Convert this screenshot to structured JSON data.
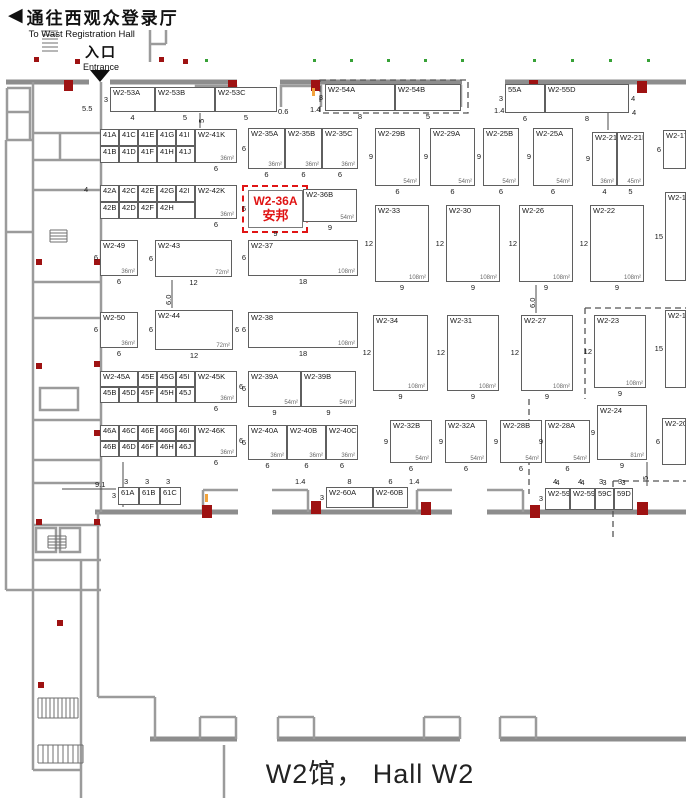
{
  "header": {
    "west_hall_cn": "通往西观众登录厅",
    "west_hall_en": "To Wast Registration Hall",
    "entrance_cn": "入口",
    "entrance_en": "Entrance"
  },
  "footer": {
    "label": "W2馆， Hall W2"
  },
  "colors": {
    "highlight_red": "#e01414",
    "wall_gray": "#8d8d8d",
    "marker_red": "#9e1212"
  },
  "highlight_booth": {
    "id": "W2-36A",
    "company": "安邦"
  },
  "passages": [
    {
      "id": "to-hall-w3-left",
      "cn": "通往W3号馆",
      "en": "To Hall W3",
      "x": 258,
      "top": 34,
      "order": "cn-first"
    },
    {
      "id": "to-hall-w3-right",
      "cn": "通往W3号馆",
      "en": "To Hall W3",
      "x": 483,
      "top": 34,
      "order": "cn-first"
    },
    {
      "id": "to-hall-w1-left",
      "cn": "通往W1号馆",
      "en": "To Hall W1",
      "x": 261,
      "top": 474,
      "order": "en-first"
    },
    {
      "id": "to-hall-w1-right",
      "cn": "通往W1号馆",
      "en": "To Hall W1",
      "x": 470,
      "top": 472,
      "order": "en-first"
    },
    {
      "id": "to-hall-w2-left",
      "cn": "通往W2号馆",
      "en": "To Hall W2",
      "x": 258,
      "top": 692,
      "order": "cn-first"
    },
    {
      "id": "to-hall-w2-right",
      "cn": "通往W2号馆",
      "en": "To Hall W2",
      "x": 483,
      "top": 692,
      "order": "cn-first"
    }
  ],
  "rooms": [
    {
      "id": "wc-upper",
      "cn": "WC",
      "x": 59,
      "y": 163,
      "cs": 11
    },
    {
      "id": "meeting-room",
      "cn": "会议室",
      "en": "Meeting Room",
      "x": 59,
      "y": 201,
      "cs": 13
    },
    {
      "id": "restaurant",
      "cn": "餐饮",
      "en": "Restaurant",
      "x": 56,
      "y": 339,
      "cs": 13
    },
    {
      "id": "wc-lower",
      "cn": "WC",
      "x": 59,
      "y": 422,
      "cs": 11
    },
    {
      "id": "self-help-center",
      "cn": "自助中心",
      "en": "Self-help center",
      "x": 55,
      "y": 500,
      "cs": 10
    }
  ],
  "booths": [
    {
      "l": "W2-53A",
      "x": 110,
      "y": 87,
      "w": 45,
      "h": 25,
      "dl": "3",
      "db": "4"
    },
    {
      "l": "W2-53B",
      "x": 155,
      "y": 87,
      "w": 60,
      "h": 25,
      "db": "5"
    },
    {
      "l": "W2-53C",
      "x": 215,
      "y": 87,
      "w": 62,
      "h": 25,
      "db": "5"
    },
    {
      "l": "W2-54A",
      "x": 325,
      "y": 84,
      "w": 70,
      "h": 27,
      "dl": "3",
      "db": "8"
    },
    {
      "l": "W2-54B",
      "x": 395,
      "y": 84,
      "w": 66,
      "h": 27,
      "db": "5"
    },
    {
      "l": "55A",
      "x": 505,
      "y": 84,
      "w": 40,
      "h": 29,
      "dl": "3",
      "db": "6"
    },
    {
      "l": "W2-55D",
      "x": 545,
      "y": 84,
      "w": 84,
      "h": 29,
      "db": "8",
      "dr": "4"
    },
    {
      "l": "W2-35A",
      "x": 248,
      "y": 128,
      "w": 37,
      "h": 41,
      "a": "36m²",
      "dl": "6",
      "db": "6"
    },
    {
      "l": "W2-35B",
      "x": 285,
      "y": 128,
      "w": 37,
      "h": 41,
      "a": "36m²",
      "db": "6"
    },
    {
      "l": "W2-35C",
      "x": 322,
      "y": 128,
      "w": 36,
      "h": 41,
      "a": "36m²",
      "db": "6"
    },
    {
      "l": "W2-29B",
      "x": 375,
      "y": 128,
      "w": 45,
      "h": 58,
      "a": "54m²",
      "dl": "9",
      "db": "6"
    },
    {
      "l": "W2-29A",
      "x": 430,
      "y": 128,
      "w": 45,
      "h": 58,
      "a": "54m²",
      "dl": "9",
      "db": "6"
    },
    {
      "l": "W2-25B",
      "x": 483,
      "y": 128,
      "w": 36,
      "h": 58,
      "a": "54m²",
      "dl": "9",
      "db": "6"
    },
    {
      "l": "W2-25A",
      "x": 533,
      "y": 128,
      "w": 40,
      "h": 58,
      "a": "54m²",
      "dl": "9",
      "db": "6"
    },
    {
      "l": "W2-21A",
      "x": 592,
      "y": 132,
      "w": 25,
      "h": 54,
      "a": "36m²",
      "dl": "9",
      "db": "4"
    },
    {
      "l": "W2-21B",
      "x": 617,
      "y": 132,
      "w": 27,
      "h": 54,
      "a": "45m²",
      "db": "5"
    },
    {
      "l": "W2-17",
      "x": 663,
      "y": 130,
      "w": 23,
      "h": 39,
      "dl": "6"
    },
    {
      "l": "W2-36A",
      "x": 248,
      "y": 190,
      "w": 55,
      "h": 38,
      "hl": true,
      "sub": "安邦",
      "db": "9",
      "dl": "6"
    },
    {
      "l": "W2-36B",
      "x": 303,
      "y": 189,
      "w": 54,
      "h": 33,
      "a": "54m²",
      "db": "9"
    },
    {
      "l": "W2-33",
      "x": 375,
      "y": 205,
      "w": 54,
      "h": 77,
      "a": "108m²",
      "dl": "12",
      "db": "9"
    },
    {
      "l": "W2-30",
      "x": 446,
      "y": 205,
      "w": 54,
      "h": 77,
      "a": "108m²",
      "dl": "12",
      "db": "9"
    },
    {
      "l": "W2-26",
      "x": 519,
      "y": 205,
      "w": 54,
      "h": 77,
      "a": "108m²",
      "dl": "12",
      "db": "9"
    },
    {
      "l": "W2-22",
      "x": 590,
      "y": 205,
      "w": 54,
      "h": 77,
      "a": "108m²",
      "dl": "12",
      "db": "9"
    },
    {
      "l": "W2-18",
      "x": 665,
      "y": 192,
      "w": 21,
      "h": 89,
      "dl": "15"
    },
    {
      "l": "W2-49",
      "x": 100,
      "y": 240,
      "w": 38,
      "h": 36,
      "a": "36m²",
      "dl": "6",
      "db": "6"
    },
    {
      "l": "W2-43",
      "x": 155,
      "y": 240,
      "w": 77,
      "h": 37,
      "a": "72m²",
      "dl": "6",
      "db": "12"
    },
    {
      "l": "W2-37",
      "x": 248,
      "y": 240,
      "w": 110,
      "h": 36,
      "a": "108m²",
      "dl": "6",
      "db": "18"
    },
    {
      "l": "W2-50",
      "x": 100,
      "y": 312,
      "w": 38,
      "h": 36,
      "a": "36m²",
      "dl": "6",
      "db": "6"
    },
    {
      "l": "W2-44",
      "x": 155,
      "y": 310,
      "w": 78,
      "h": 40,
      "a": "72m²",
      "dl": "6",
      "dr": "6",
      "db": "12"
    },
    {
      "l": "W2-38",
      "x": 248,
      "y": 312,
      "w": 110,
      "h": 36,
      "a": "108m²",
      "dl": "6",
      "db": "18"
    },
    {
      "l": "W2-34",
      "x": 373,
      "y": 315,
      "w": 55,
      "h": 76,
      "a": "108m²",
      "dl": "12",
      "db": "9"
    },
    {
      "l": "W2-31",
      "x": 447,
      "y": 315,
      "w": 52,
      "h": 76,
      "a": "108m²",
      "dl": "12",
      "db": "9"
    },
    {
      "l": "W2-27",
      "x": 521,
      "y": 315,
      "w": 52,
      "h": 76,
      "a": "108m²",
      "dl": "12",
      "db": "9"
    },
    {
      "l": "W2-23",
      "x": 594,
      "y": 315,
      "w": 52,
      "h": 73,
      "a": "108m²",
      "dl": "12",
      "db": "9"
    },
    {
      "l": "W2-19",
      "x": 665,
      "y": 310,
      "w": 21,
      "h": 78,
      "dl": "15"
    },
    {
      "l": "W2-39A",
      "x": 248,
      "y": 371,
      "w": 53,
      "h": 36,
      "a": "54m²",
      "dl": "6",
      "db": "9"
    },
    {
      "l": "W2-39B",
      "x": 301,
      "y": 371,
      "w": 55,
      "h": 36,
      "a": "54m²",
      "db": "9"
    },
    {
      "l": "W2-40A",
      "x": 248,
      "y": 425,
      "w": 39,
      "h": 35,
      "a": "36m²",
      "dl": "6",
      "db": "6"
    },
    {
      "l": "W2-40B",
      "x": 287,
      "y": 425,
      "w": 39,
      "h": 35,
      "a": "36m²",
      "db": "6"
    },
    {
      "l": "W2-40C",
      "x": 326,
      "y": 425,
      "w": 32,
      "h": 35,
      "a": "36m²",
      "db": "6"
    },
    {
      "l": "W2-32B",
      "x": 390,
      "y": 420,
      "w": 42,
      "h": 43,
      "a": "54m²",
      "dl": "9",
      "db": "6"
    },
    {
      "l": "W2-32A",
      "x": 445,
      "y": 420,
      "w": 42,
      "h": 43,
      "a": "54m²",
      "dl": "9",
      "db": "6"
    },
    {
      "l": "W2-28B",
      "x": 500,
      "y": 420,
      "w": 42,
      "h": 43,
      "a": "54m²",
      "dl": "9",
      "db": "6"
    },
    {
      "l": "W2-28A",
      "x": 545,
      "y": 420,
      "w": 45,
      "h": 43,
      "a": "54m²",
      "dl": "9",
      "db": "6"
    },
    {
      "l": "W2-24",
      "x": 597,
      "y": 405,
      "w": 50,
      "h": 55,
      "a": "81m²",
      "dl": "9",
      "db": "9"
    },
    {
      "l": "W2-20",
      "x": 662,
      "y": 418,
      "w": 24,
      "h": 47,
      "dl": "6"
    },
    {
      "l": "W2-60A",
      "x": 326,
      "y": 487,
      "w": 47,
      "h": 21,
      "dl": "3",
      "dt": "8"
    },
    {
      "l": "W2-60B",
      "x": 373,
      "y": 487,
      "w": 35,
      "h": 21,
      "dt": "6"
    },
    {
      "l": "W2-59A",
      "x": 545,
      "y": 488,
      "w": 25,
      "h": 22,
      "dl": "3",
      "dt": "4"
    },
    {
      "l": "W2-59B",
      "x": 570,
      "y": 488,
      "w": 25,
      "h": 22,
      "dt": "4"
    },
    {
      "l": "59C",
      "x": 595,
      "y": 488,
      "w": 19,
      "h": 22,
      "dt": "3"
    },
    {
      "l": "59D",
      "x": 614,
      "y": 488,
      "w": 19,
      "h": 22,
      "dt": "3"
    }
  ],
  "grids": [
    {
      "x": 100,
      "y": 129,
      "cw": 19,
      "rh": 17,
      "rows": [
        [
          "41A",
          "41C",
          "41E",
          "41G",
          "41I"
        ],
        [
          "41B",
          "41D",
          "41F",
          "41H",
          "41J"
        ]
      ],
      "k": {
        "l": "W2-41K",
        "w": 42,
        "a": "36m²"
      },
      "db": "6"
    },
    {
      "x": 100,
      "y": 185,
      "cw": 19,
      "rh": 17,
      "rows": [
        [
          "42A",
          "42C",
          "42E",
          "42G",
          "42I"
        ],
        [
          "42B",
          "42D",
          "42F",
          "42H"
        ]
      ],
      "spans": [
        [
          1,
          1,
          1,
          1,
          1
        ],
        [
          1,
          1,
          1,
          2
        ]
      ],
      "k": {
        "l": "W2-42K",
        "w": 42,
        "a": "36m²"
      },
      "db": "6"
    },
    {
      "x": 100,
      "y": 371,
      "cw": 19,
      "rh": 16,
      "rows": [
        [
          "W2-45A",
          "45E",
          "45G",
          "45I"
        ],
        [
          "45B",
          "45D",
          "45F",
          "45H",
          "45J"
        ]
      ],
      "spans": [
        [
          2,
          1,
          1,
          1
        ],
        [
          1,
          1,
          1,
          1,
          1
        ]
      ],
      "k": {
        "l": "W2-45K",
        "w": 42,
        "a": "36m²"
      },
      "db": "6",
      "dr": "6"
    },
    {
      "x": 100,
      "y": 425,
      "cw": 19,
      "rh": 16,
      "rows": [
        [
          "46A",
          "46C",
          "46E",
          "46G",
          "46I"
        ],
        [
          "46B",
          "46D",
          "46F",
          "46H",
          "46J"
        ]
      ],
      "k": {
        "l": "W2-46K",
        "w": 42,
        "a": "36m²"
      },
      "db": "6",
      "dr": "6"
    },
    {
      "x": 118,
      "y": 487,
      "cw": 21,
      "rh": 18,
      "rows": [
        [
          "61A",
          "61B",
          "61C"
        ]
      ],
      "dl": "3"
    }
  ],
  "texts": [
    {
      "t": "5.5",
      "x": 82,
      "y": 104
    },
    {
      "t": "0.6",
      "x": 278,
      "y": 107
    },
    {
      "t": "1.4",
      "x": 310,
      "y": 105
    },
    {
      "t": "1.4",
      "x": 494,
      "y": 106
    },
    {
      "t": "4",
      "x": 632,
      "y": 108
    },
    {
      "t": "5",
      "x": 197,
      "y": 123,
      "rot": 1
    },
    {
      "t": "6.0",
      "x": 164,
      "y": 305,
      "rot": 1
    },
    {
      "t": "6.0",
      "x": 528,
      "y": 308,
      "rot": 1
    },
    {
      "t": "9.1",
      "x": 95,
      "y": 480
    },
    {
      "t": "3",
      "x": 124,
      "y": 477
    },
    {
      "t": "3",
      "x": 145,
      "y": 477
    },
    {
      "t": "3",
      "x": 166,
      "y": 477
    },
    {
      "t": "1.4",
      "x": 295,
      "y": 477
    },
    {
      "t": "1.4",
      "x": 409,
      "y": 477
    },
    {
      "t": "4",
      "x": 553,
      "y": 477
    },
    {
      "t": "4",
      "x": 578,
      "y": 477
    },
    {
      "t": "3",
      "x": 599,
      "y": 477
    },
    {
      "t": "3",
      "x": 618,
      "y": 477
    },
    {
      "t": "5",
      "x": 641,
      "y": 480,
      "rot": 1
    },
    {
      "t": "4",
      "x": 84,
      "y": 185
    }
  ]
}
